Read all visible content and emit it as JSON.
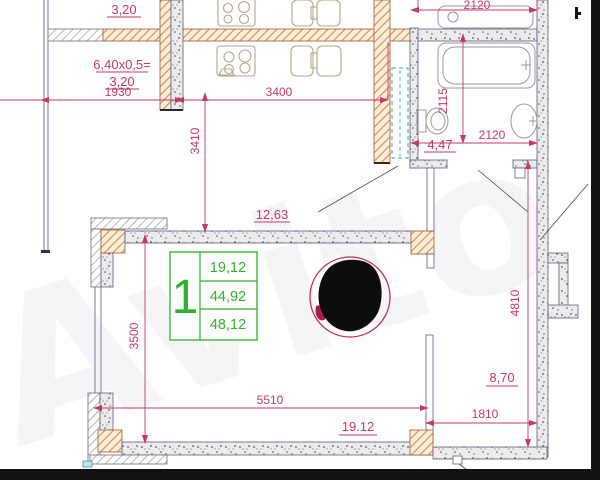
{
  "watermark": "Avito",
  "unit_table": {
    "number": "1",
    "rows": [
      "19,12",
      "44,92",
      "48,12"
    ]
  },
  "labels": {
    "balcony_top_area": "3,20",
    "balcony_formula": "6,40х0,5=",
    "balcony_area": "3,20",
    "kitchen_area": "12,63",
    "bathroom_area": "4,47",
    "living_area": "19.12",
    "hall_area": "8,70"
  },
  "dimensions": {
    "balcony_width": "1930",
    "kitchen_width": "3400",
    "kitchen_depth": "3410",
    "bath_width_top": "2120",
    "bath_depth": "2115",
    "bath_width": "2120",
    "living_depth": "3500",
    "living_width": "5510",
    "hall_width": "1810",
    "hall_depth": "4810"
  },
  "colors": {
    "dimension_text": "#c23a64",
    "table_green": "#2fb02f",
    "wall_hatch_orange": "#d08b50",
    "wall_speckle": "#ececec",
    "redaction_fill": "#0d0d0d",
    "redaction_ring": "#bf3356",
    "frame_black": "#121212"
  }
}
